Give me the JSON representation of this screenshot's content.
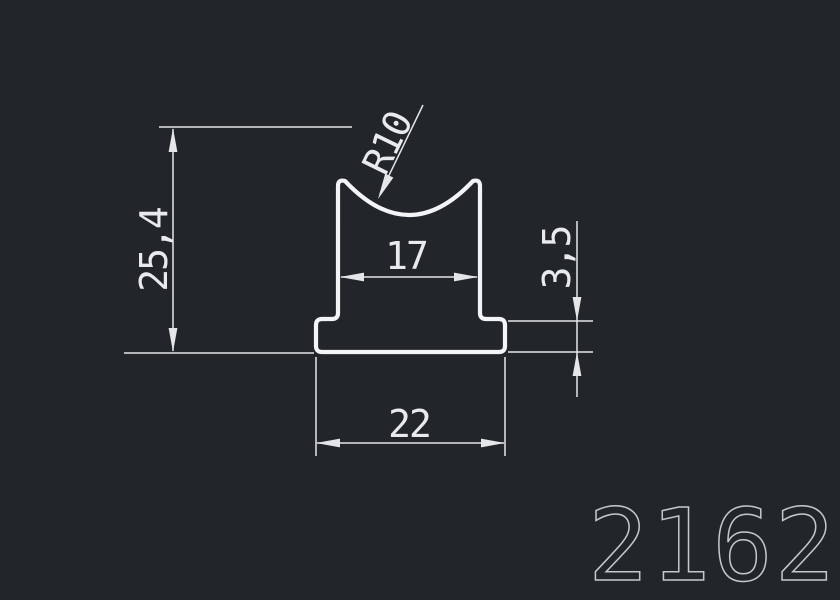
{
  "drawing": {
    "type": "cad-profile-cross-section",
    "part_number": "2162",
    "labels": {
      "height": "25,4",
      "radius": "R10",
      "top_width": "17",
      "base_thickness": "3,5",
      "base_width": "22"
    },
    "colors": {
      "background": "#22262b",
      "profile_line": "#f2f4f5",
      "dimension_line": "#e4e6e8",
      "dimension_text": "#e8eaec",
      "part_number": "#c5c8ca"
    }
  }
}
